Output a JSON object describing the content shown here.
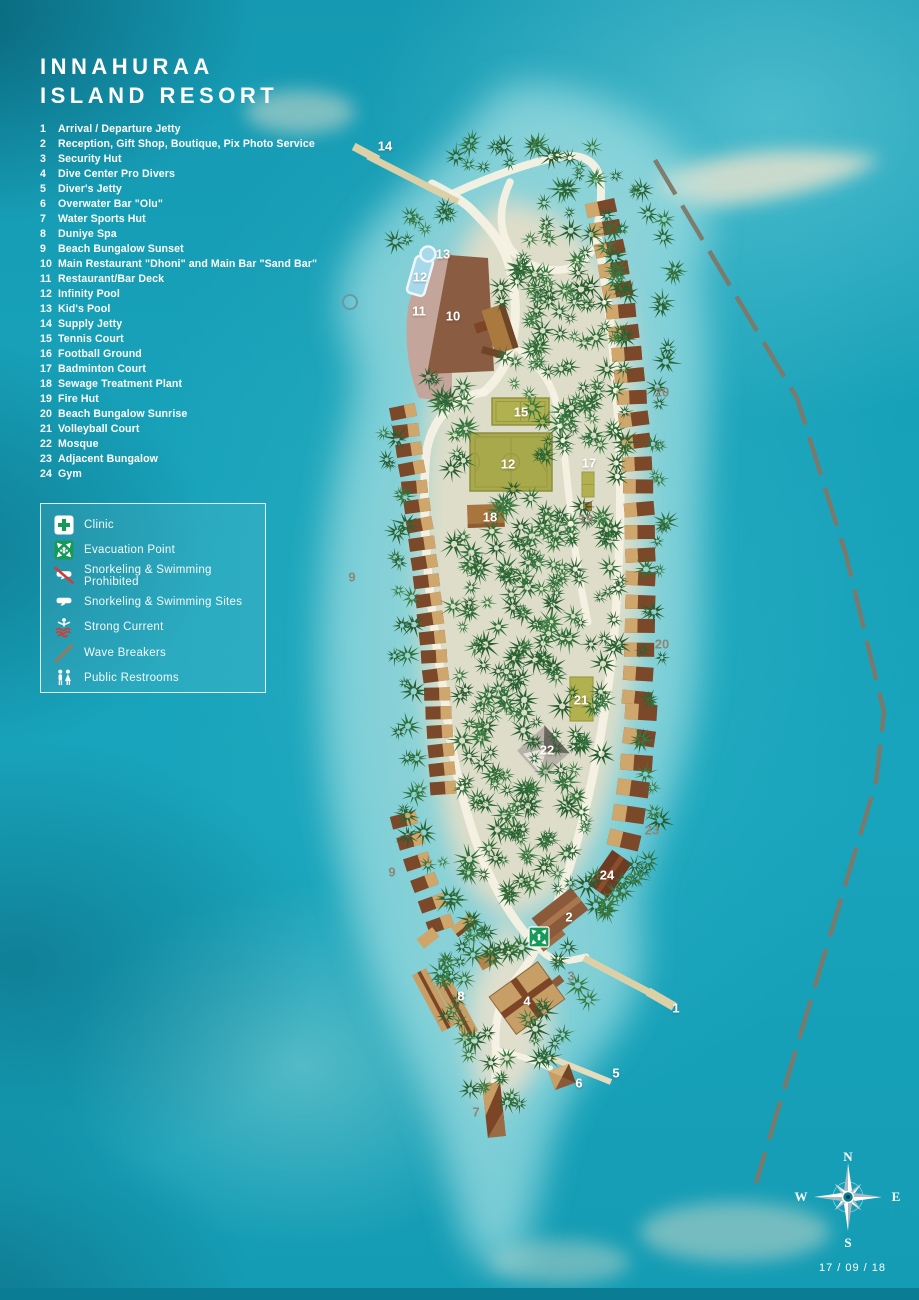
{
  "title": {
    "line1": "INNAHURAA",
    "line2": "ISLAND RESORT"
  },
  "numbered_legend": [
    {
      "num": "1",
      "label": "Arrival / Departure Jetty"
    },
    {
      "num": "2",
      "label": "Reception, Gift Shop, Boutique, Pix Photo Service"
    },
    {
      "num": "3",
      "label": "Security Hut"
    },
    {
      "num": "4",
      "label": "Dive Center Pro Divers"
    },
    {
      "num": "5",
      "label": "Diver's Jetty"
    },
    {
      "num": "6",
      "label": "Overwater Bar \"Olu\""
    },
    {
      "num": "7",
      "label": "Water Sports Hut"
    },
    {
      "num": "8",
      "label": "Duniye Spa"
    },
    {
      "num": "9",
      "label": "Beach Bungalow Sunset"
    },
    {
      "num": "10",
      "label": "Main Restaurant \"Dhoni\" and Main Bar \"Sand Bar\""
    },
    {
      "num": "11",
      "label": "Restaurant/Bar Deck"
    },
    {
      "num": "12",
      "label": "Infinity Pool"
    },
    {
      "num": "13",
      "label": "Kid's Pool"
    },
    {
      "num": "14",
      "label": "Supply Jetty"
    },
    {
      "num": "15",
      "label": "Tennis Court"
    },
    {
      "num": "16",
      "label": "Football Ground"
    },
    {
      "num": "17",
      "label": "Badminton Court"
    },
    {
      "num": "18",
      "label": "Sewage Treatment Plant"
    },
    {
      "num": "19",
      "label": "Fire Hut"
    },
    {
      "num": "20",
      "label": "Beach Bungalow Sunrise"
    },
    {
      "num": "21",
      "label": "Volleyball Court"
    },
    {
      "num": "22",
      "label": "Mosque"
    },
    {
      "num": "23",
      "label": "Adjacent Bungalow"
    },
    {
      "num": "24",
      "label": "Gym"
    }
  ],
  "legend_box": {
    "items": [
      {
        "icon": "clinic-icon",
        "label": "Clinic"
      },
      {
        "icon": "evacuation-point-icon",
        "label": "Evacuation Point"
      },
      {
        "icon": "snorkeling-prohibited-icon",
        "label": "Snorkeling & Swimming Prohibited"
      },
      {
        "icon": "snorkeling-sites-icon",
        "label": "Snorkeling & Swimming Sites"
      },
      {
        "icon": "strong-current-icon",
        "label": "Strong Current"
      },
      {
        "icon": "wave-breakers-icon",
        "label": "Wave Breakers"
      },
      {
        "icon": "public-restrooms-icon",
        "label": "Public Restrooms"
      }
    ]
  },
  "map_labels": [
    {
      "text": "14",
      "x": 385,
      "y": 146,
      "tone": "light"
    },
    {
      "text": "13",
      "x": 443,
      "y": 254,
      "tone": "light"
    },
    {
      "text": "12",
      "x": 420,
      "y": 277,
      "tone": "light"
    },
    {
      "text": "11",
      "x": 419,
      "y": 311,
      "tone": "light"
    },
    {
      "text": "10",
      "x": 453,
      "y": 316,
      "tone": "light"
    },
    {
      "text": "15",
      "x": 521,
      "y": 412,
      "tone": "light"
    },
    {
      "text": "12",
      "x": 508,
      "y": 464,
      "tone": "light"
    },
    {
      "text": "17",
      "x": 589,
      "y": 463,
      "tone": "light"
    },
    {
      "text": "18",
      "x": 490,
      "y": 517,
      "tone": "light"
    },
    {
      "text": "19",
      "x": 586,
      "y": 519,
      "tone": "dark"
    },
    {
      "text": "20",
      "x": 662,
      "y": 392,
      "tone": "dark"
    },
    {
      "text": "20",
      "x": 662,
      "y": 644,
      "tone": "dark"
    },
    {
      "text": "9",
      "x": 352,
      "y": 577,
      "tone": "dark"
    },
    {
      "text": "9",
      "x": 392,
      "y": 872,
      "tone": "dark"
    },
    {
      "text": "21",
      "x": 581,
      "y": 700,
      "tone": "light"
    },
    {
      "text": "22",
      "x": 547,
      "y": 750,
      "tone": "light"
    },
    {
      "text": "23",
      "x": 652,
      "y": 830,
      "tone": "dark"
    },
    {
      "text": "24",
      "x": 607,
      "y": 875,
      "tone": "light"
    },
    {
      "text": "2",
      "x": 569,
      "y": 917,
      "tone": "light"
    },
    {
      "text": "3",
      "x": 571,
      "y": 976,
      "tone": "dark"
    },
    {
      "text": "1",
      "x": 676,
      "y": 1008,
      "tone": "light"
    },
    {
      "text": "4",
      "x": 527,
      "y": 1001,
      "tone": "light"
    },
    {
      "text": "8",
      "x": 461,
      "y": 996,
      "tone": "light"
    },
    {
      "text": "5",
      "x": 616,
      "y": 1073,
      "tone": "light"
    },
    {
      "text": "6",
      "x": 579,
      "y": 1083,
      "tone": "light"
    },
    {
      "text": "7",
      "x": 476,
      "y": 1112,
      "tone": "dark"
    }
  ],
  "compass": {
    "n": "N",
    "e": "E",
    "s": "S",
    "w": "W"
  },
  "date": "17 / 09 / 18",
  "colors": {
    "sea": "#18a4bc",
    "sand": "#f6f1e2",
    "palm": "#2e6a36",
    "bungalow_dark": "#7b4829",
    "bungalow_light": "#cfa66b",
    "court_green": "#b1b150",
    "accent_green": "#169a58",
    "alert_red": "#d63b33",
    "jetty": "#dcd0a8",
    "wave_breaker": "#7d7868"
  }
}
